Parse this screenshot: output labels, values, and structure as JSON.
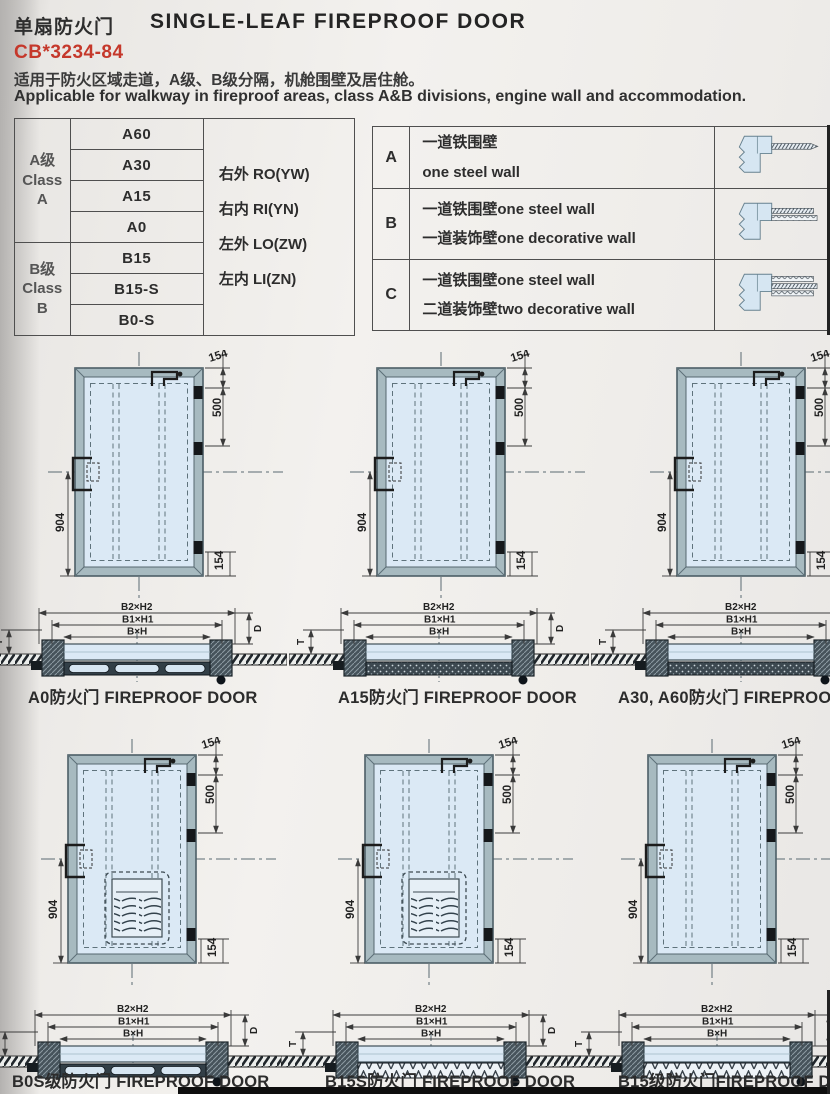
{
  "header": {
    "title_cn": "单扇防火门",
    "title_en": "SINGLE-LEAF FIREPROOF DOOR",
    "standard": "CB*3234-84",
    "desc_cn": "适用于防火区域走道，A级、B级分隔，机舱围壁及居住舱。",
    "desc_en": "Applicable for walkway in fireproof areas, class A&B divisions, engine wall and accommodation."
  },
  "class_table": {
    "class_a": [
      "A级",
      "Class",
      "A"
    ],
    "class_b": [
      "B级",
      "Class",
      "B"
    ],
    "a_rows": [
      "A60",
      "A30",
      "A15",
      "A0"
    ],
    "b_rows": [
      "B15",
      "B15-S",
      "B0-S"
    ],
    "orient": [
      "右外 RO(YW)",
      "右内 RI(YN)",
      "左外 LO(ZW)",
      "左内 LI(ZN)"
    ]
  },
  "wall_table": {
    "rows": [
      {
        "key": "A",
        "line1": "一道铁围壁",
        "line2": "one steel wall"
      },
      {
        "key": "B",
        "line1": "一道铁围壁one steel wall",
        "line2": "一道装饰壁one decorative wall"
      },
      {
        "key": "C",
        "line1": "一道铁围壁one steel wall",
        "line2": "二道装饰壁two decorative wall"
      }
    ]
  },
  "dims": {
    "top": "154",
    "upper_right": "500",
    "height": "904",
    "bottom_right": "154"
  },
  "section_labels": {
    "outer": "B2×H2",
    "middle": "B1×H1",
    "inner": "B×H",
    "depth": "D",
    "thickness": "T"
  },
  "doors": [
    {
      "label": "A0防火门 FIREPROOF DOOR"
    },
    {
      "label": "A15防火门 FIREPROOF DOOR"
    },
    {
      "label": "A30, A60防火门 FIREPROOF D"
    },
    {
      "label": "B0S级防火门 FIREPROOF DOOR"
    },
    {
      "label": "B15S防火门 FIREPROOF DOOR"
    },
    {
      "label": "B15级防火门FIREPROOF DOC"
    }
  ],
  "colors": {
    "accent_red": "#c5382b",
    "panel_blue": "#dbe9f5",
    "frame_gray": "#a7bac0",
    "line_dark": "#333333"
  }
}
